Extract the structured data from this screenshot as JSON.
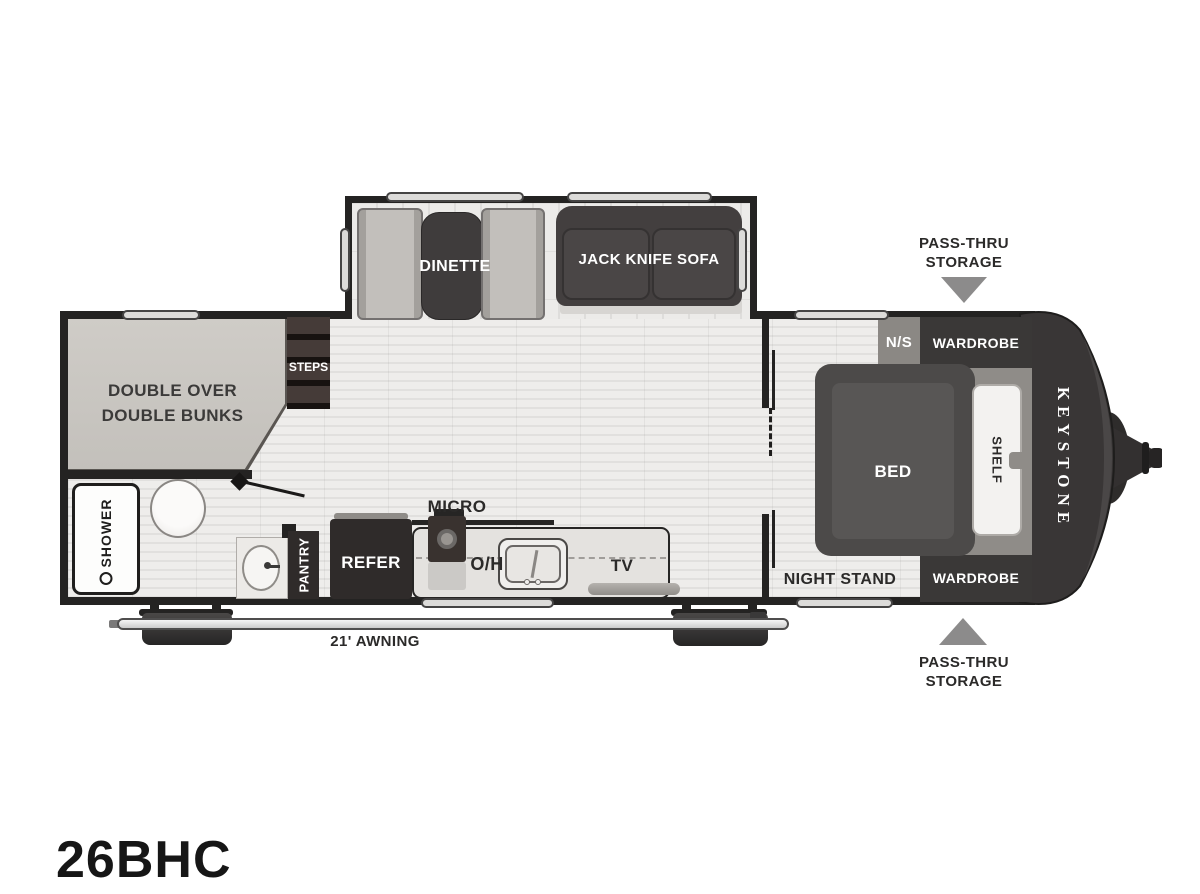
{
  "title": "26BHC",
  "brand": "KEYSTONE",
  "labels": {
    "dinette": "DINETTE",
    "jack_knife_sofa": "JACK KNIFE SOFA",
    "bunks_line1": "DOUBLE OVER",
    "bunks_line2": "DOUBLE BUNKS",
    "steps": "STEPS",
    "shower": "SHOWER",
    "pantry": "PANTRY",
    "refer": "REFER",
    "micro": "MICRO",
    "overhead": "O/H",
    "tv": "TV",
    "night_stand": "NIGHT STAND",
    "ns": "N/S",
    "wardrobe_front_top": "WARDROBE",
    "wardrobe_front_bottom": "WARDROBE",
    "bed": "BED",
    "shelf": "SHELF",
    "awning": "21' AWNING",
    "pass_thru_line1": "PASS-THRU",
    "pass_thru_line2": "STORAGE"
  },
  "colors": {
    "wall": "#242322",
    "furniture_dark": "#3a3837",
    "bunk_gray": "#c9c6c1",
    "floor_light": "#eeedeb",
    "floor_stripe": "#e1e0de",
    "arrow_gray": "#8c8b8b",
    "label_dark": "#2b2a29",
    "label_white": "#ffffff"
  }
}
